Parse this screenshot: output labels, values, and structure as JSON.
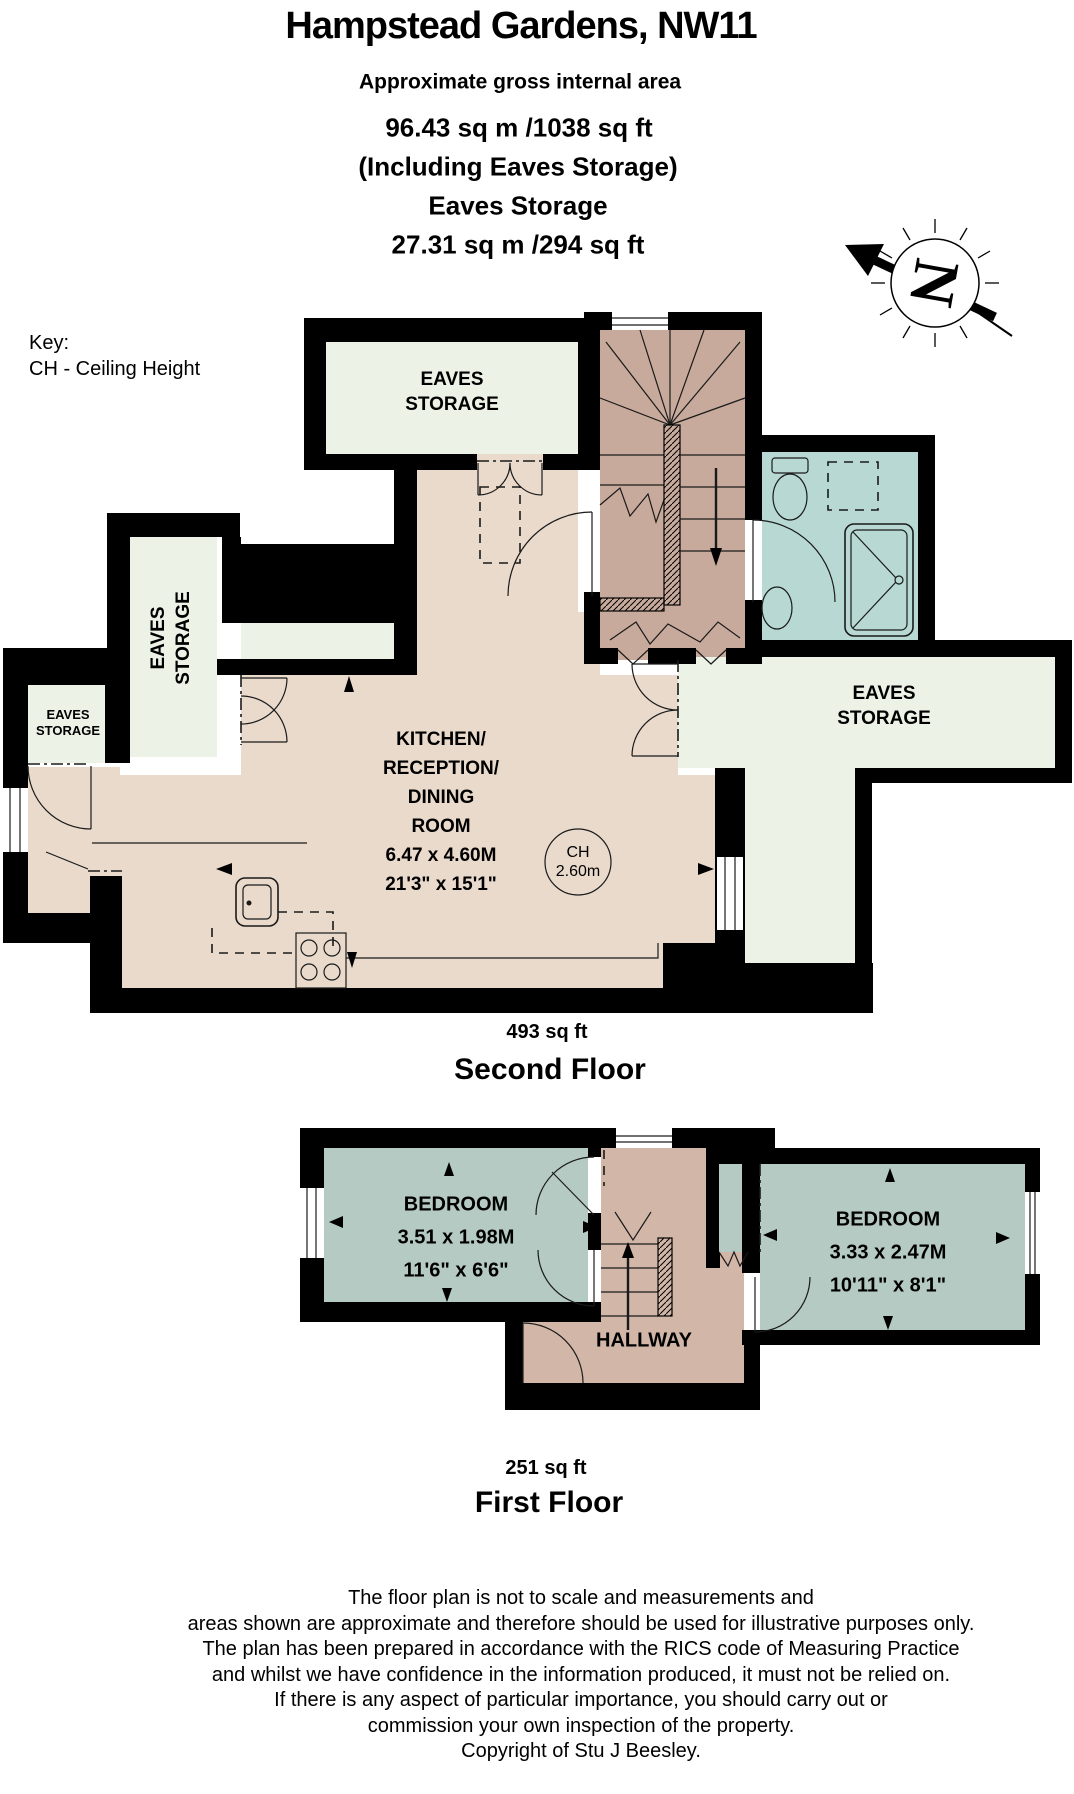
{
  "header": {
    "title": "Hampstead Gardens, NW11",
    "subtitle": "Approximate gross internal area",
    "total_area": "96.43 sq m /1038 sq ft",
    "including": "(Including Eaves Storage)",
    "eaves_title": "Eaves Storage",
    "eaves_area": "27.31 sq m /294 sq ft"
  },
  "key": {
    "title": "Key:",
    "entry": "CH - Ceiling Height"
  },
  "compass": {
    "letter": "N"
  },
  "second_floor": {
    "area": "493 sq ft",
    "name": "Second Floor",
    "eaves_top": {
      "line1": "EAVES",
      "line2": "STORAGE"
    },
    "eaves_left_tall": {
      "line1": "EAVES",
      "line2": "STORAGE"
    },
    "eaves_left_small": {
      "line1": "EAVES",
      "line2": "STORAGE"
    },
    "eaves_right": {
      "line1": "EAVES",
      "line2": "STORAGE"
    },
    "kitchen": {
      "lines": [
        "KITCHEN/",
        "RECEPTION/",
        "DINING",
        "ROOM",
        "6.47 x 4.60M",
        "21'3\" x 15'1\""
      ]
    },
    "ceiling_height": {
      "line1": "CH",
      "line2": "2.60m"
    }
  },
  "first_floor": {
    "area": "251 sq ft",
    "name": "First Floor",
    "bedroom_left": {
      "lines": [
        "BEDROOM",
        "3.51 x 1.98M",
        "11'6\" x 6'6\""
      ]
    },
    "bedroom_right": {
      "lines": [
        "BEDROOM",
        "3.33 x 2.47M",
        "10'11\" x 8'1\""
      ]
    },
    "hallway": "HALLWAY"
  },
  "disclaimer": {
    "lines": [
      "The floor plan is not to scale and measurements and",
      "areas shown are approximate and therefore should be used for illustrative purposes only.",
      "The plan has been prepared in accordance with the RICS code of Measuring Practice",
      "and whilst we have confidence in the information produced, it must not be relied on.",
      "If there is any aspect of particular importance, you should carry out or",
      "commission your own inspection of the property.",
      "Copyright of Stu J Beesley."
    ]
  },
  "colors": {
    "wall": "#000000",
    "eaves": "#ecf2e6",
    "room": "#e9dacc",
    "stairs": "#c8aa9c",
    "hallway": "#d2b6a8",
    "bath": "#b7d8d3",
    "bedroom": "#b5cac3"
  }
}
